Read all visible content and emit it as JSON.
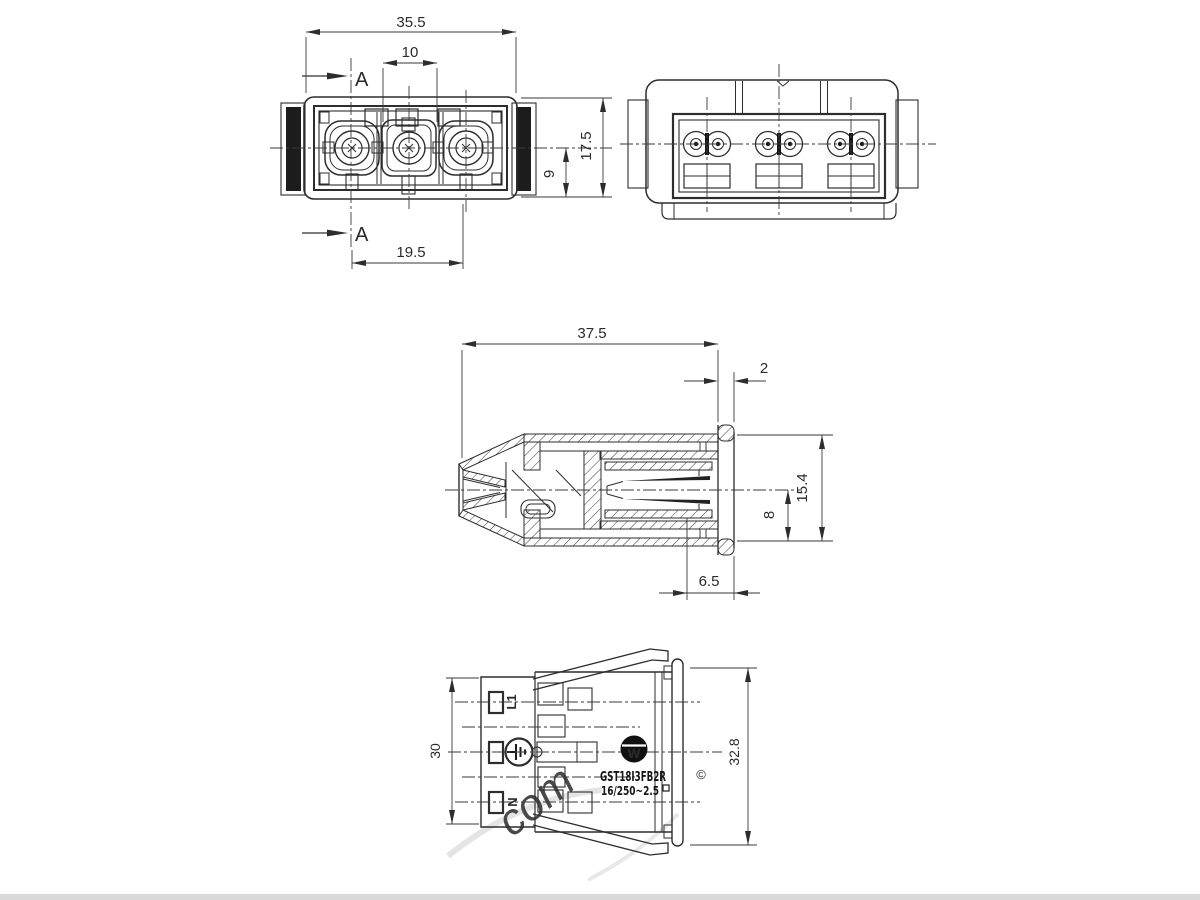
{
  "page": {
    "background": "#ffffff",
    "line_color": "#2d2d2d",
    "watermark_color": "#d6d6d6",
    "scan_bar_color": "#d9d9d9"
  },
  "views": {
    "front": {
      "section_label": "A",
      "dims": {
        "overall_width": "35.5",
        "pole_spacing": "10",
        "overall_height": "17.5",
        "center_to_bottom": "9",
        "outer_pole_spacing": "19.5"
      }
    },
    "section": {
      "dims": {
        "overall_length": "37.5",
        "flange_thickness": "2",
        "flange_height": "15.4",
        "center_to_bottom": "8",
        "rear_offset": "6.5"
      }
    },
    "side": {
      "dims": {
        "body_height": "30",
        "flange_height": "32.8"
      },
      "pole_labels": {
        "line": "L1",
        "neutral": "N"
      },
      "earth_icon": "earth-symbol",
      "markings": {
        "logo_letter": "W",
        "part_number": "GST18I3FB2R",
        "rating": "16/250~2.5",
        "rating_square": "□",
        "copyright": "©"
      }
    },
    "watermark": {
      "text": "com"
    }
  }
}
